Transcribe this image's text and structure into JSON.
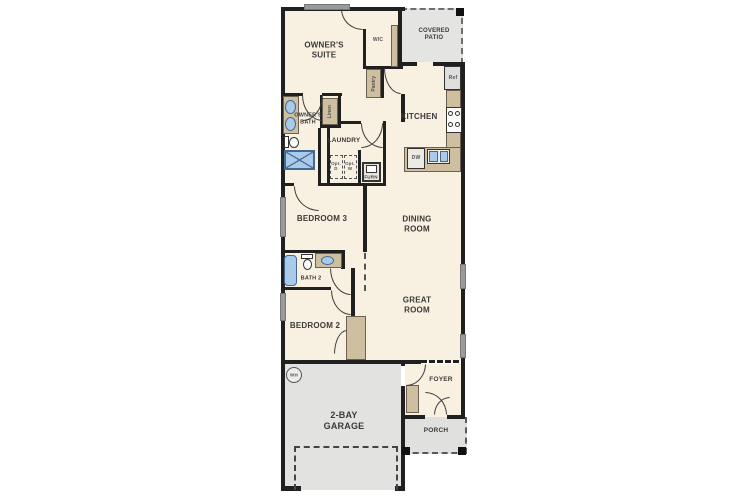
{
  "floor_plan": {
    "labels": {
      "owners_suite_1": "OWNER'S",
      "owners_suite_2": "SUITE",
      "wic": "WIC",
      "covered_patio_1": "COVERED",
      "covered_patio_2": "PATIO",
      "pantry": "Pantry",
      "linen": "Linen",
      "owners_bath_1": "OWNER'S",
      "owners_bath_2": "BATH",
      "laundry": "LAUNDRY",
      "opt_d_1": "Opt.",
      "opt_d_2": "D",
      "opt_w_1": "Opt.",
      "opt_w_2": "W",
      "furn": "FURN",
      "kitchen": "KITCHEN",
      "ref": "Ref",
      "dw": "DW",
      "bedroom3": "BEDROOM 3",
      "dining_1": "DINING",
      "dining_2": "ROOM",
      "bath2": "BATH 2",
      "bedroom2": "BEDROOM 2",
      "great_1": "GREAT",
      "great_2": "ROOM",
      "foyer": "FOYER",
      "porch": "PORCH",
      "garage_1": "2-BAY",
      "garage_2": "GARAGE",
      "wh": "WH"
    },
    "colors": {
      "floor": "#f8f1e2",
      "wall": "#202020",
      "patio_gray": "#e4e4e2",
      "garage_gray": "#e2e2e0",
      "counter_tan": "#cdbfa0",
      "fixture_blue": "#a9cbe9",
      "window_gray": "#9a9a9a",
      "text": "#3a3a3a"
    }
  }
}
